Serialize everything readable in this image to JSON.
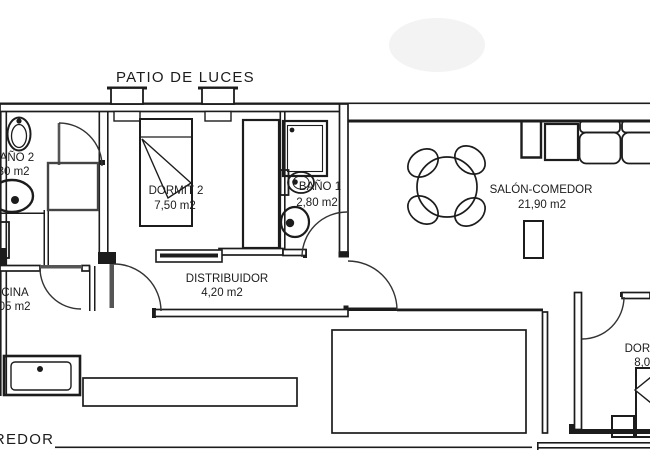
{
  "patio": {
    "label": "PATIO DE LUCES"
  },
  "corridor": {
    "label": "CORREDOR"
  },
  "rooms": {
    "bano2": {
      "name": "BAÑO 2",
      "area": "3,30 m2"
    },
    "dormit2": {
      "name": "DORMIT 2",
      "area": "7,50 m2"
    },
    "bano1": {
      "name": "BAÑO 1",
      "area": "2,80 m2"
    },
    "salon": {
      "name": "SALÓN-COMEDOR",
      "area": "21,90 m2"
    },
    "distribuidor": {
      "name": "DISTRIBUIDOR",
      "area": "4,20 m2"
    },
    "cocina": {
      "name": "COCINA",
      "area": "7,05 m2"
    },
    "dormit1": {
      "name": "DORMIT 1",
      "area": "8,05 m2"
    }
  },
  "colors": {
    "line": "#1c1c1c",
    "door": "#555555",
    "background": "#ffffff",
    "watermark": "#f3f3f3"
  }
}
